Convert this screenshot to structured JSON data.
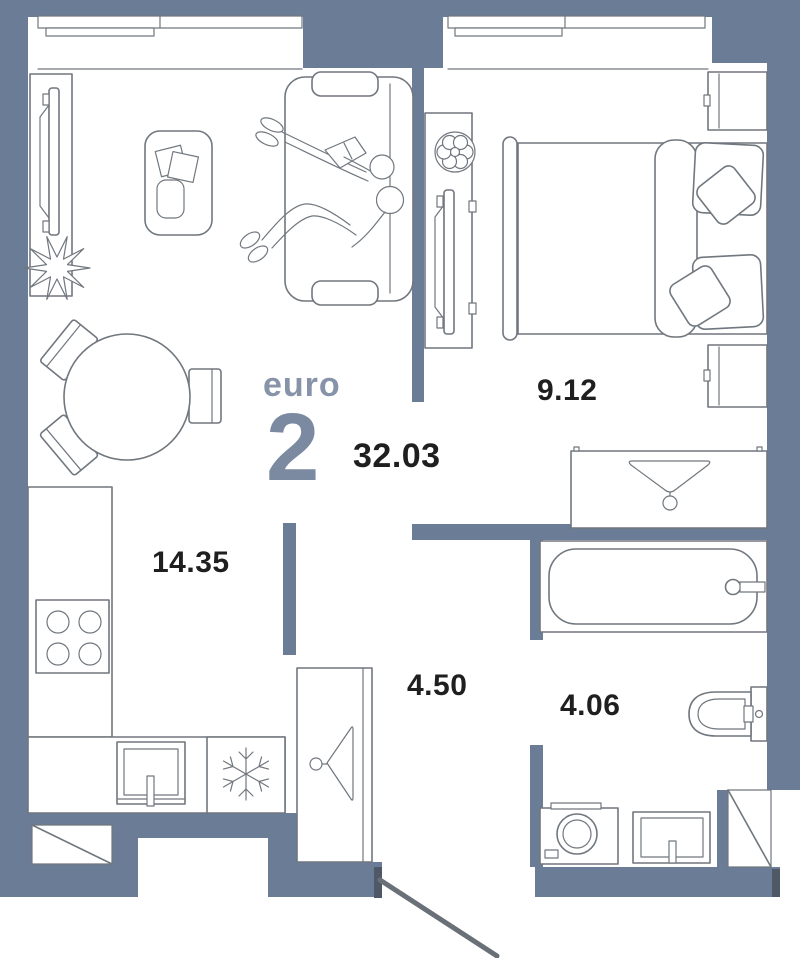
{
  "floor_plan": {
    "unit_type_label": "euro",
    "unit_rooms_number": "2",
    "total_area": "32.03",
    "rooms": [
      {
        "name": "living-room-with-kitchen",
        "area": "14.35"
      },
      {
        "name": "bedroom",
        "area": "9.12"
      },
      {
        "name": "hallway",
        "area": "4.50"
      },
      {
        "name": "bathroom",
        "area": "4.06"
      }
    ],
    "colors": {
      "wall": "#6B7C97",
      "furniture_line": "#70777E",
      "door_frame": "#4F5866",
      "door_leaf": "#6A7077",
      "unit_type_text": "#8693A8",
      "unit_number_text": "#7B8AA0",
      "area_text": "#1F1F1F"
    }
  }
}
